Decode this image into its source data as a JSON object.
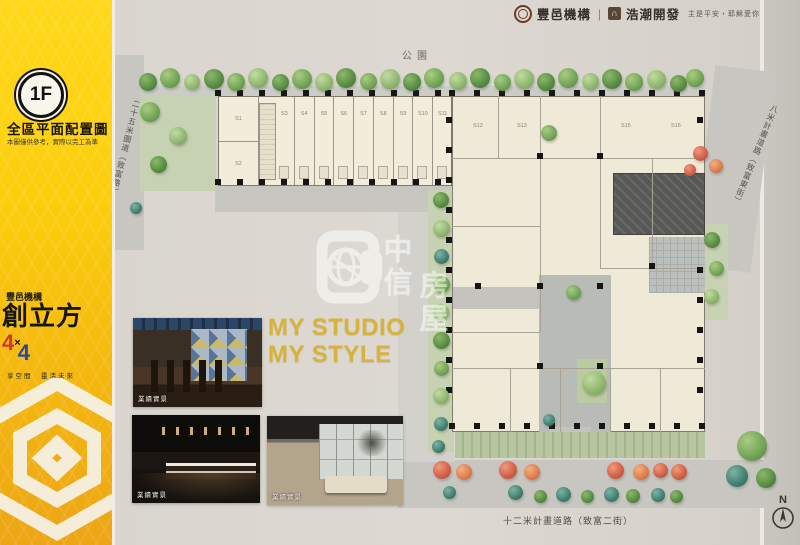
{
  "left_panel": {
    "floor_badge": "1F",
    "title": "全區平面配置圖",
    "disclaimer": "本圖僅供參考，實際以完工為準",
    "brand_company": "豐邑機構",
    "brand_product": "創立方",
    "brand_4a": "4",
    "brand_times": "×",
    "brand_4b": "4",
    "brand_tagline": "享空間　靈活未來"
  },
  "header": {
    "company1": "豐邑機構",
    "divider": "|",
    "company2_logo_glyph": "∩",
    "company2": "浩潮開發",
    "slogan": "主是平安・耶穌愛你"
  },
  "plan": {
    "park_label": "公園",
    "road_left": "二十五米園道（致富路）",
    "road_right": "八米計畫道路（致富東街）",
    "road_bottom": "十二米計畫道路（致富二街）",
    "units_left": [
      "S1",
      "S2"
    ],
    "units_top": [
      "S3",
      "S4",
      "S5",
      "S6",
      "S7",
      "S8",
      "S9",
      "S10",
      "S11"
    ],
    "units_right": [
      "S12",
      "S13",
      "S15",
      "S16"
    ],
    "compass": "N"
  },
  "watermark": {
    "col1": "中信",
    "col2": "房屋"
  },
  "showcase": {
    "headline_line1": "MY STUDIO",
    "headline_line2": "MY STYLE",
    "photos": [
      {
        "caption": "業績實景"
      },
      {
        "caption": "業績實景"
      },
      {
        "caption": "業績實景"
      }
    ]
  },
  "colors": {
    "banner_yellow": "#fccf0e",
    "headline_gold": "#d7b33c",
    "four_red": "#d03a2c",
    "four_blue": "#274a9e",
    "road_gray": "#c7c6c1",
    "building_cream": "#efe9d7",
    "tree_green": "#6fa254",
    "tree_red": "#d05c44"
  }
}
